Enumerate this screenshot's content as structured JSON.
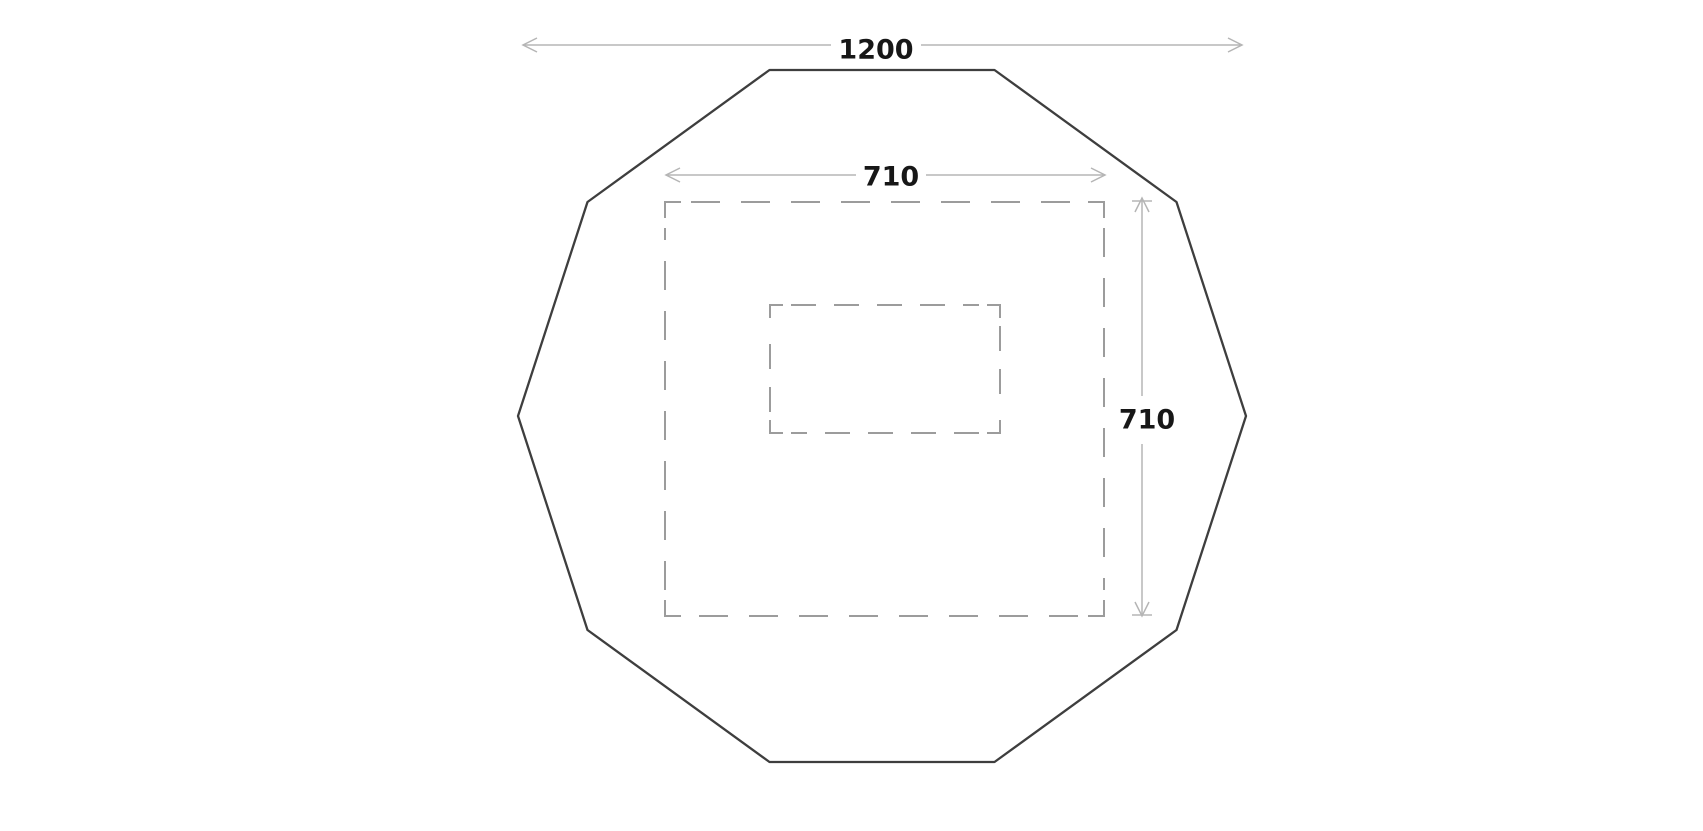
{
  "diagram": {
    "description": "Plan-view dimensioned drawing of a decagonal tent footprint with inner dashed platform outline",
    "canvas": {
      "width": 1703,
      "height": 827,
      "background": "#ffffff"
    },
    "colors": {
      "outline": "#3e3e3e",
      "dashed": "#9c9c9c",
      "dimension_line": "#b5b5b5",
      "label_text": "#171717"
    },
    "decagon": {
      "name": "decagon-outline",
      "center": [
        882,
        416
      ],
      "radius": 364,
      "points": [
        [
          1246,
          416
        ],
        [
          1176.5,
          202
        ],
        [
          994.5,
          70
        ],
        [
          769.5,
          70
        ],
        [
          587.5,
          202
        ],
        [
          518,
          416
        ],
        [
          587.5,
          630
        ],
        [
          769.5,
          762
        ],
        [
          994.5,
          762
        ],
        [
          1176.5,
          630
        ]
      ]
    },
    "outer_square": {
      "name": "outer-dashed-square",
      "x": 665,
      "y": 202,
      "w": 439,
      "h": 414,
      "corner_leg": 16,
      "dash": "29 21",
      "side_inset": 26
    },
    "inner_rect": {
      "name": "inner-dashed-rect",
      "x": 770,
      "y": 305,
      "w": 230,
      "h": 128,
      "corner_leg": 13,
      "dash": "25 18",
      "side_inset": 21
    },
    "dimensions": [
      {
        "id": "overall-width",
        "label": "1200",
        "orientation": "horizontal",
        "line_y": 45,
        "from_x": 523,
        "to_x": 1242,
        "gap": [
          831,
          921
        ],
        "label_x": 876,
        "label_y": 50,
        "tip_bars": false
      },
      {
        "id": "platform-width",
        "label": "710",
        "orientation": "horizontal",
        "line_y": 175,
        "from_x": 666,
        "to_x": 1105,
        "gap": [
          856,
          926
        ],
        "label_x": 891,
        "label_y": 177,
        "tip_bars": false
      },
      {
        "id": "platform-height",
        "label": "710",
        "orientation": "vertical",
        "line_x": 1142,
        "from_y": 198,
        "to_y": 616,
        "gap": [
          396,
          444
        ],
        "label_x": 1147,
        "label_y": 420,
        "tip_bars": true
      }
    ]
  }
}
